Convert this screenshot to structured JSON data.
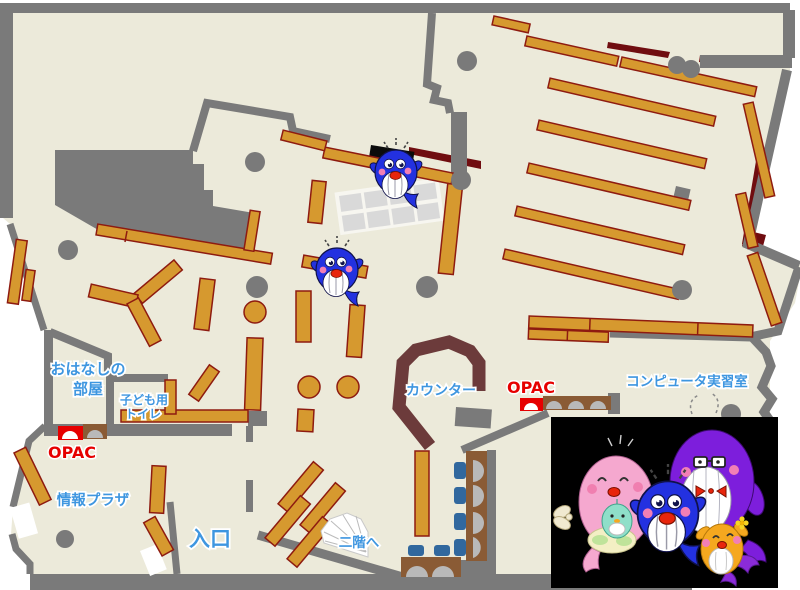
{
  "labels": {
    "storytelling_room_line1": "おはなしの",
    "storytelling_room_line2": "部屋",
    "kids_toilet_line1": "子ども用",
    "kids_toilet_line2": "トイレ",
    "opac_left": "OPAC",
    "opac_right": "OPAC",
    "info_plaza": "情報プラザ",
    "entrance": "入口",
    "counter": "カウンター",
    "to_second_floor": "二階へ",
    "computer_room": "コンピュータ実習室"
  },
  "icons": {
    "map_whale_icon": "blue whale mascot marker (appears twice on map)",
    "mascot_family": [
      "pink-whale-mother-with-baby",
      "blue-whale-child",
      "purple-whale-father-glasses-bowtie",
      "orange-whale-child-flower"
    ],
    "stairs_icon": "fan-shaped staircase to 2nd floor",
    "opac_terminal_icon": "arched OPAC terminal (red) beside brown reader desks",
    "pillar_icon": "gray circle structural pillar"
  },
  "colors": {
    "floor": "#ECEADA",
    "wall": "#7A7A7A",
    "bookshelf": "#D6992F",
    "bookshelf_border": "#8E1B10",
    "dark_red": "#700D10",
    "counter": "#6C3B3B",
    "label_blue": "#3E96E0",
    "opac_red": "#E60000",
    "chair_blue": "#31689E",
    "desk_brown": "#8A5B35",
    "mascot_bg": "#000000"
  }
}
